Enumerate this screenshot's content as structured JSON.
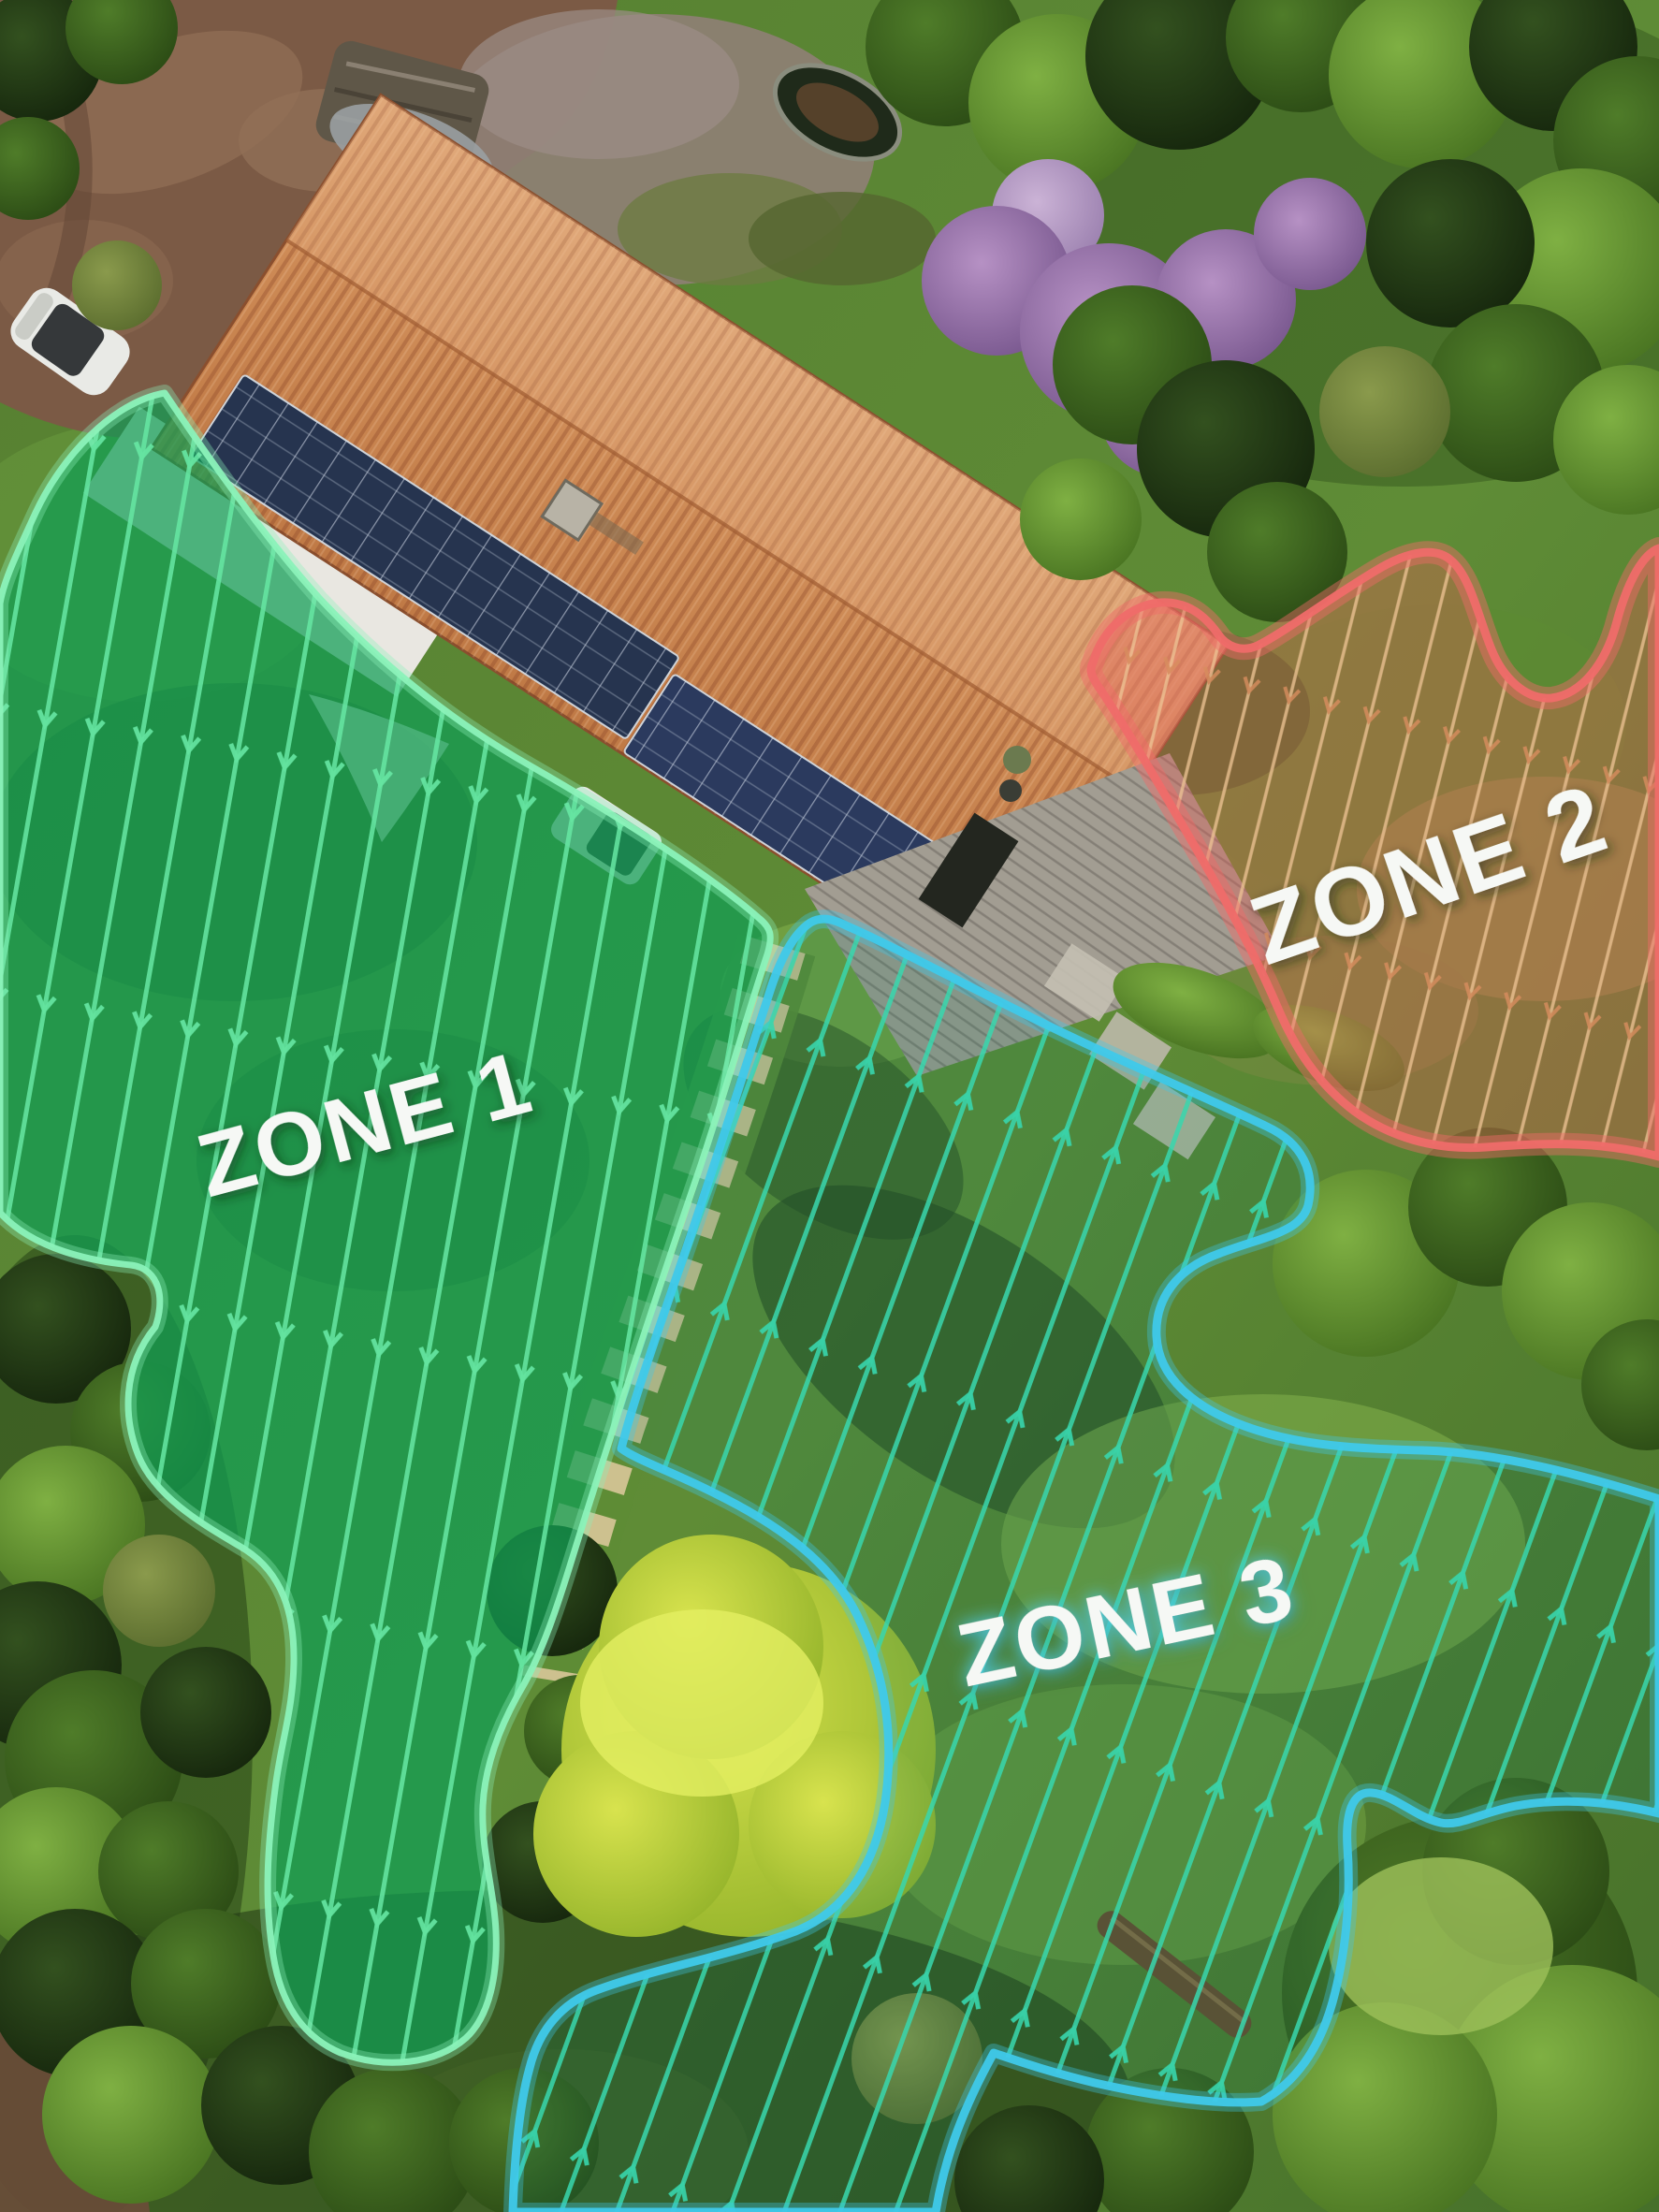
{
  "zones": [
    {
      "label": "ZONE 1",
      "fill_color": "#0f9e55",
      "stripe_color": "#66e7a3",
      "border_color": "#8bf2b9",
      "arrow_direction": "down"
    },
    {
      "label": "ZONE 2",
      "fill_color": "#e25b54",
      "stripe_color": "#eec394",
      "border_color": "#ef6b69",
      "arrow_direction": "down"
    },
    {
      "label": "ZONE 3",
      "fill_color": "#0c7a5e",
      "stripe_color": "#38d6ad",
      "border_color": "#3fc9ea",
      "arrow_direction": "up"
    }
  ]
}
